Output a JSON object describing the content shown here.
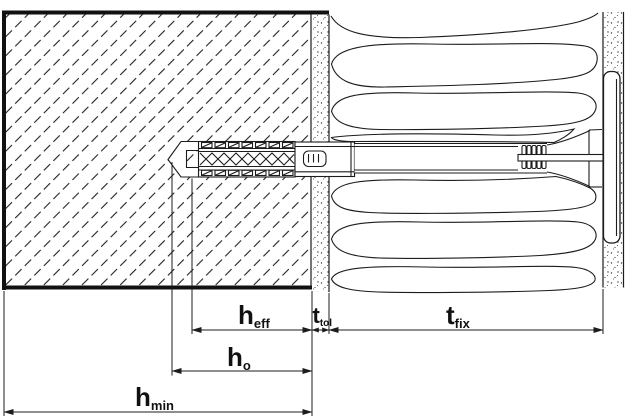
{
  "diagram_labels": {
    "h_eff": {
      "symbol": "h",
      "subscript": "eff"
    },
    "t_tol": {
      "symbol": "t",
      "subscript": "tol"
    },
    "t_fix": {
      "symbol": "t",
      "subscript": "fix"
    },
    "h_o": {
      "symbol": "h",
      "subscript": "o"
    },
    "h_min": {
      "symbol": "h",
      "subscript": "min"
    }
  },
  "colors": {
    "line": "#1c1c1c",
    "background": "#ffffff"
  }
}
